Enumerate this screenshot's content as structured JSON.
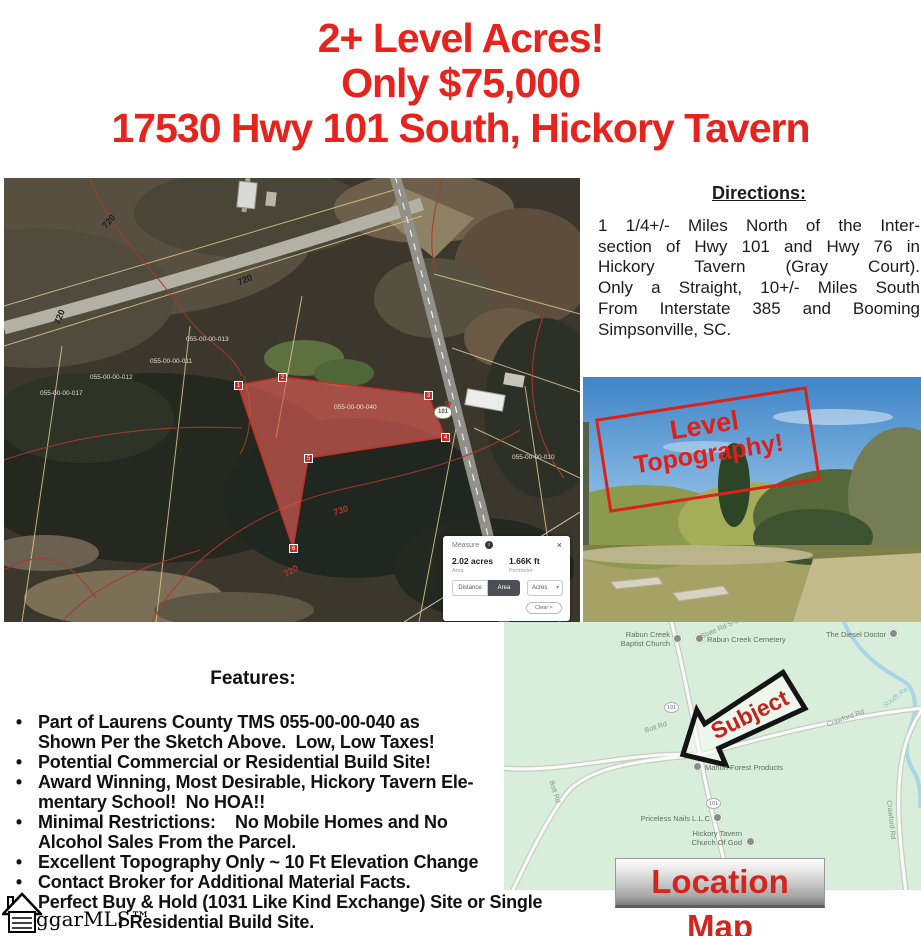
{
  "header": {
    "line1": "2+ Level Acres!",
    "line2": "Only $75,000",
    "line3": "17530 Hwy 101 South, Hickory Tavern"
  },
  "sketch_map": {
    "contour_labels": [
      "720",
      "720",
      "720",
      "730",
      "730",
      "730",
      "720"
    ],
    "parcel_labels": [
      "055-00-00-040",
      "055-00-00-012",
      "055-00-00-011",
      "055-00-00-013",
      "055-00-00-010",
      "055-00-00-017"
    ],
    "highway_shield": "101",
    "vertex_markers": [
      "1",
      "2",
      "3",
      "4",
      "5",
      "6"
    ],
    "measure_popup": {
      "title": "Measure",
      "info_icon": "i",
      "close_icon": "×",
      "area_value": "2.02 acres",
      "area_label": "Area",
      "perimeter_value": "1.66K ft",
      "perimeter_label": "Perimeter",
      "distance_tab": "Distance",
      "area_tab": "Area",
      "unit_value": "Acres",
      "unit_caret": "▾",
      "clear_label": "Clear ×"
    }
  },
  "directions": {
    "title": "Directions:",
    "lines": [
      "1 1/4+/-  Miles North of the Inter-",
      "section of Hwy 101 and Hwy 76 in",
      "Hickory Tavern (Gray Court).",
      "Only a Straight, 10+/- Miles South",
      "From Interstate 385 and Booming",
      "Simpsonville, SC."
    ]
  },
  "photo": {
    "overlay_line1": "Level",
    "overlay_line2": "Topography!"
  },
  "location_map": {
    "pois": [
      {
        "label": "Rabun Creek\nBaptist Church"
      },
      {
        "label": "Rabun Creek Cemetery"
      },
      {
        "label": "The Diesel Doctor"
      },
      {
        "label": "Mahon Forest Products"
      },
      {
        "label": "Priceless Nails L.L.C"
      },
      {
        "label": "Hickory Tavern\nChurch Of God"
      }
    ],
    "road_labels": [
      {
        "text": "State Rd S-30-77"
      },
      {
        "text": "Bolt Rd"
      },
      {
        "text": "Crawford Rd"
      },
      {
        "text": "Bolt Rd"
      },
      {
        "text": "Crawford Rd"
      },
      {
        "text": "South Re"
      }
    ],
    "shields": [
      "101",
      "101"
    ],
    "subject_label": "Subject",
    "banner": "Location Map"
  },
  "features": {
    "title": "Features:",
    "bullets": [
      {
        "lines": [
          "Part of Laurens County TMS 055-00-00-040 as",
          "Shown Per the Sketch Above.  Low, Low Taxes!"
        ]
      },
      {
        "lines": [
          "Potential Commercial or Residential Build Site!"
        ]
      },
      {
        "lines": [
          "Award Winning, Most Desirable, Hickory Tavern Ele-",
          "mentary School!  No HOA!!"
        ]
      },
      {
        "lines": [
          "Minimal Restrictions:    No Mobile Homes and No",
          "Alcohol Sales From the Parcel."
        ]
      },
      {
        "lines": [
          "Excellent Topography Only ~ 10 Ft Elevation Change"
        ]
      },
      {
        "lines": [
          "Contact Broker for Additional Material Facts."
        ]
      },
      {
        "lines": [
          "Perfect Buy & Hold (1031 Like Kind Exchange) Site or Single",
          "r Residential Build Site."
        ]
      }
    ]
  },
  "watermark": {
    "text": "ggarMLS™"
  },
  "colors": {
    "headline_red": "#e6231d",
    "overlay_red": "#dd2018",
    "banner_red": "#d3241e",
    "map_green": "#d8edda",
    "parcel_fill": "#d85c54"
  }
}
